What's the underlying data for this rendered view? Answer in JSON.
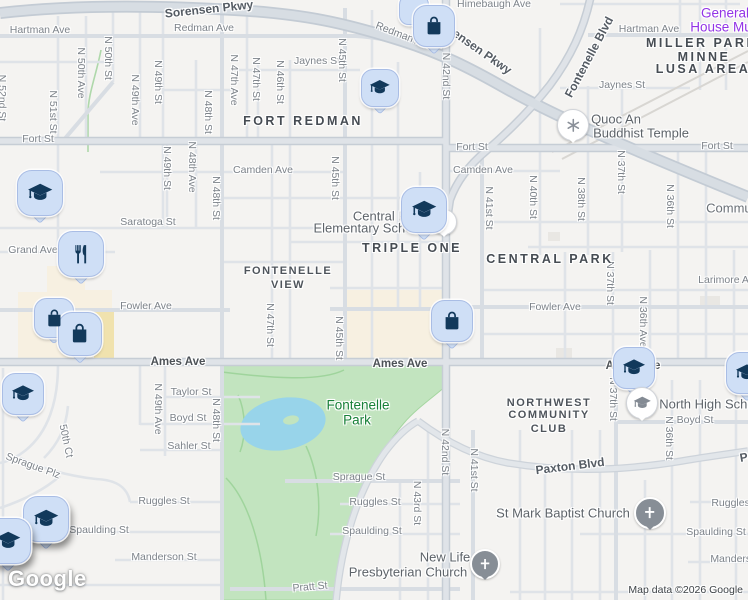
{
  "map": {
    "watermark": "Google",
    "attribution": "Map data ©2026 Google",
    "colors": {
      "land": "#f4f3f1",
      "park": "#c2e4bf",
      "water": "#98d4ea",
      "road": "#dfe3e8",
      "road_casing": "#c6cdd5",
      "commercial": "#f7f0e1",
      "building_yellow": "#f0e2ae",
      "pin_fill": "#cfdff6",
      "pin_border": "#a9bde5",
      "pin_glyph": "#12395b",
      "poi_gray": "#878e96",
      "purple": "#9334e6",
      "park_label": "#188038"
    },
    "labels": [
      {
        "t": "Sorensen Pkwy",
        "x": 209,
        "y": 9,
        "r": -6,
        "c": "mj"
      },
      {
        "t": "Sorensen Pkwy",
        "x": 474,
        "y": 46,
        "r": 35,
        "c": "mj"
      },
      {
        "t": "Hartman Ave",
        "x": 40,
        "y": 30,
        "r": 0,
        "c": "st"
      },
      {
        "t": "Redman Ave",
        "x": 204,
        "y": 28,
        "r": 0,
        "c": "st"
      },
      {
        "t": "Redman Ave",
        "x": 404,
        "y": 36,
        "r": 21,
        "c": "st"
      },
      {
        "t": "Himebaugh Ave",
        "x": 494,
        "y": 4,
        "r": 0,
        "c": "st"
      },
      {
        "t": "Hartman Ave",
        "x": 649,
        "y": 29,
        "r": 0,
        "c": "st"
      },
      {
        "t": "Jaynes St",
        "x": 317,
        "y": 61,
        "r": 0,
        "c": "st"
      },
      {
        "t": "Jaynes St",
        "x": 622,
        "y": 85,
        "r": 0,
        "c": "st"
      },
      {
        "t": "Fort St",
        "x": 38,
        "y": 139,
        "r": 0,
        "c": "st"
      },
      {
        "t": "Fort St",
        "x": 472,
        "y": 147,
        "r": 0,
        "c": "st"
      },
      {
        "t": "Fort St",
        "x": 717,
        "y": 146,
        "r": 0,
        "c": "st"
      },
      {
        "t": "Camden Ave",
        "x": 263,
        "y": 170,
        "r": 0,
        "c": "st"
      },
      {
        "t": "Camden Ave",
        "x": 483,
        "y": 170,
        "r": 0,
        "c": "st"
      },
      {
        "t": "Saratoga St",
        "x": 148,
        "y": 222,
        "r": 0,
        "c": "st"
      },
      {
        "t": "Grand Ave",
        "x": 33,
        "y": 250,
        "r": 0,
        "c": "st"
      },
      {
        "t": "Fowler Ave",
        "x": 146,
        "y": 306,
        "r": 0,
        "c": "st"
      },
      {
        "t": "Fowler Ave",
        "x": 555,
        "y": 307,
        "r": 0,
        "c": "st"
      },
      {
        "t": "Ames Ave",
        "x": 178,
        "y": 362,
        "r": 0,
        "c": "stb"
      },
      {
        "t": "Ames Ave",
        "x": 400,
        "y": 364,
        "r": 0,
        "c": "stb"
      },
      {
        "t": "Ames Ave",
        "x": 633,
        "y": 366,
        "r": 0,
        "c": "stb"
      },
      {
        "t": "Taylor St",
        "x": 191,
        "y": 392,
        "r": 0,
        "c": "st"
      },
      {
        "t": "Boyd St",
        "x": 188,
        "y": 418,
        "r": 0,
        "c": "st"
      },
      {
        "t": "Boyd St",
        "x": 695,
        "y": 420,
        "r": 0,
        "c": "st"
      },
      {
        "t": "Sahler St",
        "x": 189,
        "y": 446,
        "r": 0,
        "c": "st"
      },
      {
        "t": "Paxton Blvd",
        "x": 570,
        "y": 466,
        "r": -7,
        "c": "mj"
      },
      {
        "t": "Paxton Blvd",
        "x": 774,
        "y": 452,
        "r": -10,
        "c": "mj"
      },
      {
        "t": "Sprague St",
        "x": 359,
        "y": 477,
        "r": 0,
        "c": "st"
      },
      {
        "t": "Sprague Plz",
        "x": 33,
        "y": 466,
        "r": 20,
        "c": "st"
      },
      {
        "t": "50th Ct",
        "x": 66,
        "y": 441,
        "r": 78,
        "c": "st"
      },
      {
        "t": "Ruggles St",
        "x": 164,
        "y": 501,
        "r": 0,
        "c": "st"
      },
      {
        "t": "Ruggles St",
        "x": 375,
        "y": 502,
        "r": 0,
        "c": "st"
      },
      {
        "t": "Ruggles St",
        "x": 737,
        "y": 503,
        "r": 0,
        "c": "st"
      },
      {
        "t": "Spaulding St",
        "x": 99,
        "y": 530,
        "r": 0,
        "c": "st"
      },
      {
        "t": "Spaulding St",
        "x": 372,
        "y": 531,
        "r": 0,
        "c": "st"
      },
      {
        "t": "Spaulding St",
        "x": 716,
        "y": 532,
        "r": 0,
        "c": "st"
      },
      {
        "t": "Manderson St",
        "x": 164,
        "y": 557,
        "r": 0,
        "c": "st"
      },
      {
        "t": "Manderson St",
        "x": 743,
        "y": 559,
        "r": 0,
        "c": "st"
      },
      {
        "t": "Pratt St",
        "x": 310,
        "y": 587,
        "r": -5,
        "c": "st"
      },
      {
        "t": "Larimore Ave",
        "x": 729,
        "y": 280,
        "r": 0,
        "c": "st"
      },
      {
        "t": "Community",
        "x": 739,
        "y": 208,
        "r": 0,
        "c": "cm"
      },
      {
        "t": "N 52nd St",
        "x": 2,
        "y": 98,
        "r": 90,
        "c": "st"
      },
      {
        "t": "N 51st St",
        "x": 53,
        "y": 112,
        "r": 90,
        "c": "st"
      },
      {
        "t": "N 50th Ave",
        "x": 81,
        "y": 73,
        "r": 90,
        "c": "st"
      },
      {
        "t": "N 50th St",
        "x": 108,
        "y": 58,
        "r": 90,
        "c": "st"
      },
      {
        "t": "N 49th Ave",
        "x": 135,
        "y": 100,
        "r": 90,
        "c": "st"
      },
      {
        "t": "N 49th St",
        "x": 158,
        "y": 82,
        "r": 90,
        "c": "st"
      },
      {
        "t": "N 48th St",
        "x": 208,
        "y": 112,
        "r": 90,
        "c": "st"
      },
      {
        "t": "N 47th Ave",
        "x": 234,
        "y": 80,
        "r": 90,
        "c": "st"
      },
      {
        "t": "N 47th St",
        "x": 256,
        "y": 79,
        "r": 90,
        "c": "st"
      },
      {
        "t": "N 46th St",
        "x": 280,
        "y": 82,
        "r": 90,
        "c": "st"
      },
      {
        "t": "N 45th St",
        "x": 342,
        "y": 60,
        "r": 90,
        "c": "st"
      },
      {
        "t": "N 49th St",
        "x": 167,
        "y": 168,
        "r": 90,
        "c": "st"
      },
      {
        "t": "N 48th Ave",
        "x": 192,
        "y": 167,
        "r": 90,
        "c": "st"
      },
      {
        "t": "N 48th St",
        "x": 216,
        "y": 198,
        "r": 90,
        "c": "st"
      },
      {
        "t": "N 45th St",
        "x": 335,
        "y": 178,
        "r": 90,
        "c": "st"
      },
      {
        "t": "N 47th St",
        "x": 270,
        "y": 325,
        "r": 90,
        "c": "st"
      },
      {
        "t": "N 45th St",
        "x": 339,
        "y": 338,
        "r": 90,
        "c": "st"
      },
      {
        "t": "N 42nd St",
        "x": 446,
        "y": 76,
        "r": 90,
        "c": "st"
      },
      {
        "t": "N 41st St",
        "x": 489,
        "y": 208,
        "r": 90,
        "c": "st"
      },
      {
        "t": "N 40th St",
        "x": 533,
        "y": 197,
        "r": 90,
        "c": "st"
      },
      {
        "t": "N 38th St",
        "x": 581,
        "y": 199,
        "r": 90,
        "c": "st"
      },
      {
        "t": "N 37th St",
        "x": 621,
        "y": 172,
        "r": 90,
        "c": "st"
      },
      {
        "t": "N 36th St",
        "x": 670,
        "y": 206,
        "r": 90,
        "c": "st"
      },
      {
        "t": "N 37th St",
        "x": 610,
        "y": 283,
        "r": 90,
        "c": "st"
      },
      {
        "t": "N 36th Ave",
        "x": 643,
        "y": 322,
        "r": 90,
        "c": "st"
      },
      {
        "t": "N 49th Ave",
        "x": 158,
        "y": 409,
        "r": 90,
        "c": "st"
      },
      {
        "t": "N 48th St",
        "x": 216,
        "y": 420,
        "r": 90,
        "c": "st"
      },
      {
        "t": "N 37th St",
        "x": 613,
        "y": 399,
        "r": 90,
        "c": "st"
      },
      {
        "t": "N 36th St",
        "x": 669,
        "y": 438,
        "r": 90,
        "c": "st"
      },
      {
        "t": "N 42nd St",
        "x": 445,
        "y": 452,
        "r": 90,
        "c": "st"
      },
      {
        "t": "N 43rd St",
        "x": 417,
        "y": 503,
        "r": 90,
        "c": "st"
      },
      {
        "t": "N 41st St",
        "x": 474,
        "y": 470,
        "r": 90,
        "c": "st"
      },
      {
        "t": "Fontenelle Blvd",
        "x": 589,
        "y": 57,
        "r": -62,
        "c": "mj"
      },
      {
        "t": "FORT REDMAN",
        "x": 303,
        "y": 121,
        "r": 0,
        "c": "ar"
      },
      {
        "t": "MILLER PARK",
        "x": 702,
        "y": 43,
        "r": 0,
        "c": "ar"
      },
      {
        "t": "MINNE",
        "x": 704,
        "y": 57,
        "r": 0,
        "c": "ar"
      },
      {
        "t": "LUSA AREA",
        "x": 703,
        "y": 69,
        "r": 0,
        "c": "ar"
      },
      {
        "t": "TRIPLE ONE",
        "x": 412,
        "y": 248,
        "r": 0,
        "c": "ar"
      },
      {
        "t": "CENTRAL PARK",
        "x": 550,
        "y": 259,
        "r": 0,
        "c": "ar"
      },
      {
        "t": "FONTENELLE",
        "x": 288,
        "y": 271,
        "r": 0,
        "c": "ar2"
      },
      {
        "t": "VIEW",
        "x": 288,
        "y": 285,
        "r": 0,
        "c": "ar2"
      },
      {
        "t": "NORTHWEST",
        "x": 549,
        "y": 403,
        "r": 0,
        "c": "ar2"
      },
      {
        "t": "COMMUNITY",
        "x": 549,
        "y": 415,
        "r": 0,
        "c": "ar2"
      },
      {
        "t": "CLUB",
        "x": 549,
        "y": 429,
        "r": 0,
        "c": "ar2"
      },
      {
        "t": "Quoc An",
        "x": 616,
        "y": 119,
        "r": 0,
        "c": "poi"
      },
      {
        "t": "Buddhist Temple",
        "x": 641,
        "y": 133,
        "r": 0,
        "c": "poi"
      },
      {
        "t": "Central Park",
        "x": 389,
        "y": 216,
        "r": 0,
        "c": "poi"
      },
      {
        "t": "Elementary School",
        "x": 368,
        "y": 228,
        "r": 0,
        "c": "poi"
      },
      {
        "t": "North High School",
        "x": 712,
        "y": 404,
        "r": 0,
        "c": "poi"
      },
      {
        "t": "St Mark Baptist Church",
        "x": 563,
        "y": 513,
        "r": 0,
        "c": "poi"
      },
      {
        "t": "New Life",
        "x": 445,
        "y": 557,
        "r": 0,
        "c": "poi"
      },
      {
        "t": "Presbyterian Church",
        "x": 408,
        "y": 572,
        "r": 0,
        "c": "poi"
      },
      {
        "t": "General",
        "x": 725,
        "y": 13,
        "r": 0,
        "c": "poiP"
      },
      {
        "t": "House Mu",
        "x": 721,
        "y": 27,
        "r": 0,
        "c": "poiP"
      },
      {
        "t": "Fontenelle",
        "x": 358,
        "y": 405,
        "r": 0,
        "c": "pk"
      },
      {
        "t": "Park",
        "x": 357,
        "y": 420,
        "r": 0,
        "c": "pk"
      }
    ],
    "markers": [
      {
        "k": "pin-blank",
        "x": 414,
        "y": 10,
        "s": 30
      },
      {
        "k": "shopping",
        "x": 434,
        "y": 26,
        "s": 42
      },
      {
        "k": "school",
        "x": 380,
        "y": 88,
        "s": 38
      },
      {
        "k": "school",
        "x": 40,
        "y": 193,
        "s": 46
      },
      {
        "k": "food",
        "x": 81,
        "y": 254,
        "s": 46
      },
      {
        "k": "shopping",
        "x": 54,
        "y": 318,
        "s": 40
      },
      {
        "k": "shopping",
        "x": 80,
        "y": 334,
        "s": 44
      },
      {
        "k": "circle-dot",
        "x": 444,
        "y": 222,
        "s": 26
      },
      {
        "k": "school",
        "x": 424,
        "y": 210,
        "s": 46
      },
      {
        "k": "shopping",
        "x": 452,
        "y": 321,
        "s": 42
      },
      {
        "k": "school",
        "x": 23,
        "y": 394,
        "s": 42
      },
      {
        "k": "circle-temple",
        "x": 573,
        "y": 125,
        "s": 32
      },
      {
        "k": "school",
        "x": 634,
        "y": 368,
        "s": 42
      },
      {
        "k": "school",
        "x": 747,
        "y": 373,
        "s": 42
      },
      {
        "k": "circle-school",
        "x": 642,
        "y": 403,
        "s": 32
      },
      {
        "k": "school",
        "x": 46,
        "y": 519,
        "s": 46,
        "sh": true
      },
      {
        "k": "school",
        "x": 8,
        "y": 541,
        "s": 46,
        "sh": true
      },
      {
        "k": "circle-cross",
        "x": 650,
        "y": 513,
        "s": 32
      },
      {
        "k": "circle-cross",
        "x": 485,
        "y": 564,
        "s": 30
      }
    ]
  }
}
